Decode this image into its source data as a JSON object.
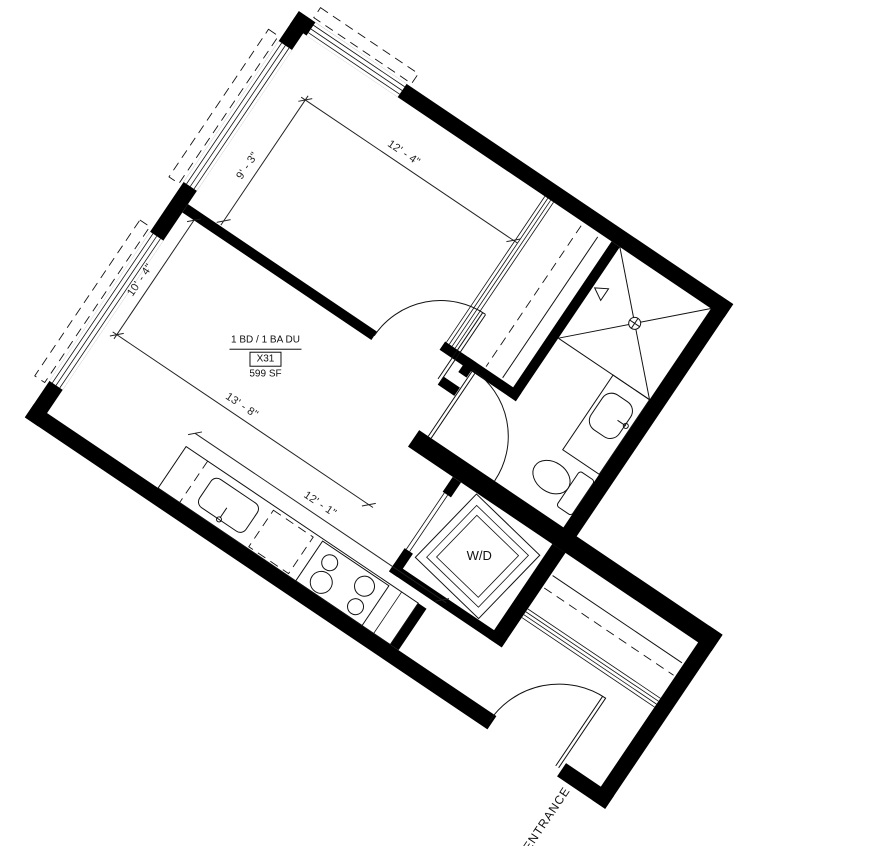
{
  "unit": {
    "type_label": "1 BD / 1 BA DU",
    "unit_number": "X31",
    "area": "599 SF"
  },
  "dimensions": {
    "bedroom_width": "12' - 4\"",
    "bedroom_depth": "9' - 3\"",
    "living_depth": "10' - 4\"",
    "living_width": "13' - 8\"",
    "kitchen_run": "12' - 1\""
  },
  "labels": {
    "washer_dryer": "W/D",
    "entrance": "ENTRANCE"
  },
  "colors": {
    "wall": "#000000",
    "line": "#111111",
    "dimension_text": "#222222",
    "background": "#ffffff"
  }
}
